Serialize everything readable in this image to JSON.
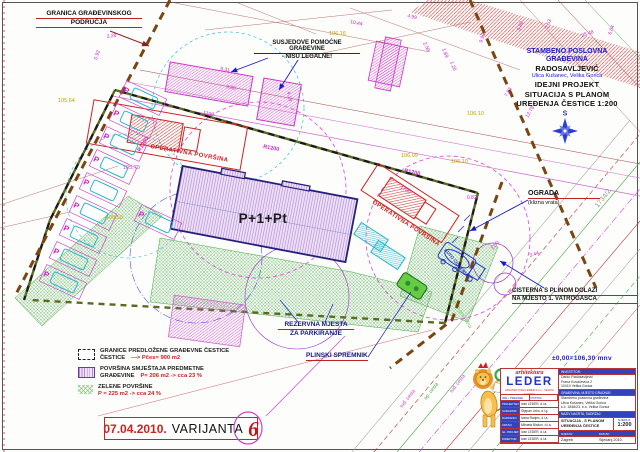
{
  "sheet": {
    "callouts": {
      "granica1": "GRANICA GRAĐEVINSKOG",
      "granica2": "PODRUČJA",
      "susjedne1": "SUSJEDOVE POMOĆNE GRAĐEVINE",
      "susjedne2": "- NISU LEGALNE!",
      "ograda1": "OGRADA",
      "ograda2": "(klizna vrata)",
      "cisterna1": "CISTERNA S PLINOM DOLAZI",
      "cisterna2": "NA MJESTO 1. VATROGASCA",
      "rezervna1": "REZERVNA MJESTA",
      "rezervna2": "ZA PARKIRANJE",
      "plinski": "PLINSKI SPREMNIK"
    },
    "project": {
      "l1": "STAMBENO POSLOVNA",
      "l2": "GRAĐEVINA",
      "l3": "RADOSAVLJEVIĆ",
      "l4": "Ulica Kušanec, Velika Gorica",
      "l5": "IDEJNI PROJEKT",
      "l6": "SITUACIJA S PLANOM",
      "l7": "UREĐENJA ČESTICE 1:200"
    },
    "compass_n": "S",
    "building_label": "P+1+Pt",
    "operativna": "OPERATIVNA POVRŠINA",
    "auto_cisterna": "AUTO CISTERNA",
    "zelena_text": "zelena površina",
    "parking_letter": "P",
    "radius_label": "R1200",
    "elevation_note": "±0,00=106,30 mnv",
    "dims": [
      "2.28",
      "0.92",
      "9.31",
      "9.60",
      "4.13",
      "1100",
      "1700",
      "10.44",
      "4.99",
      "2.50",
      "1.89",
      "1.20",
      "12.78",
      "7.83",
      "9.88",
      "25.48",
      "6.04",
      "9.92",
      "2.53",
      "2.50",
      "3.44",
      "0.82"
    ],
    "elevs": [
      "105.64",
      "105.70",
      "105.50",
      "106.16",
      "106.09",
      "106.10",
      "106.10"
    ],
    "roads": [
      "tuđ. cesta",
      "op. cesta",
      "tuđ. cesta"
    ],
    "parcel_no": "1734/2",
    "legend": {
      "row1_line1": "GRANICE PREDLOŽENE  GRAĐEVNE ČESTICE",
      "row1_line2": "ČESTICE",
      "row1_red": "—> Pčes= 900 m2",
      "row2_line1": "POVRŠINA SMJEŠTAJA PREDMETNE",
      "row2_line2": "GRAĐEVINE",
      "row2_red": "P= 206 m2 -> cca 23 %",
      "row3_line1": "ZELENE POVRŠINE",
      "row3_red": "P = 225 m2 -> cca 24 %"
    },
    "datebox": {
      "date": "07.04.2010.",
      "variant": "VARIJANTA",
      "number": "6"
    },
    "titleblock": {
      "logo_top": "arhitektura",
      "logo_main": "LEDER",
      "logo_sub": "ARHITEKTURA LEDER d.o.o., VELIKA GORICA",
      "investitor_label": "INVESTITOR:",
      "investitor_1": "Darko Radosavljević",
      "investitor_2": "Frana Kovačevića 2",
      "investitor_3": "10410 Velika Gorica",
      "gradevina_label": "GRAĐEVINA, MJESTO GRADNJE:",
      "gradevina_1": "Stambeno poslovna građevina",
      "gradevina_2": "Ulica Kušanec, Velika Gorica",
      "gradevina_3": "k.č. 1848/23, k.o. Velika Gorica",
      "nacrt_label": "NAZIV NACRTA, SADRŽAJ:",
      "nacrt_1": "SITUACIJA - S PLANOM",
      "nacrt_2": "UREĐENJA ČESTICE",
      "mjerilo_label": "MJERILO:",
      "mjerilo_value": "1:200",
      "header_name": "IME I PREZIME",
      "header_potpis": "POTPIS",
      "roles": [
        {
          "label": "PROJEKTANT:",
          "name": "Ivan LEDER, d.i.a."
        },
        {
          "label": "SURADNIK:",
          "name": "Stjepan Leko, d.i.g."
        },
        {
          "label": "RAZRADIO:",
          "name": "Ivana Ranjec, d.i.a."
        },
        {
          "label": "CRTAO:",
          "name": "Mihaela Blažon, d.i.a."
        },
        {
          "label": "GL. PROJEKTANT:",
          "name": "Ivan LEDER, d.i.a."
        },
        {
          "label": "DIREKTOR:",
          "name": "Ivan LEDER, d.i.a."
        }
      ],
      "mjesto_label": "MJESTO:",
      "mjesto_value": "Zagreb",
      "datum_label": "DATUM:",
      "datum_value": "Siječanj 2010."
    }
  }
}
